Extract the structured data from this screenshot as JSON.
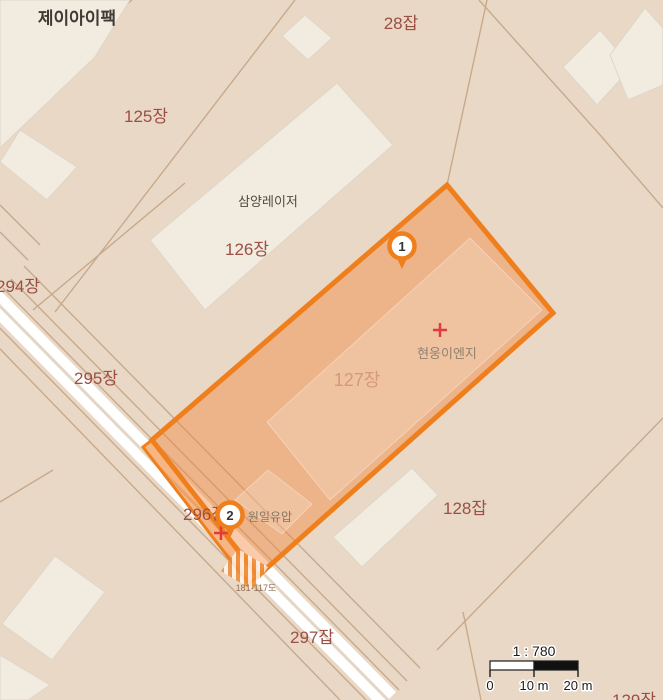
{
  "map": {
    "parcels": {
      "p28": "28잡",
      "p125": "125장",
      "p126": "126장",
      "p127": "127장",
      "p128": "128잡",
      "p129": "129장",
      "p294": "294장",
      "p295": "295장",
      "p296": "296장",
      "p297": "297잡"
    },
    "places": {
      "jay_pack": "제이아이팩",
      "samyang_laser": "삼양레이저",
      "hyunwoong_eng": "현웅이엔지",
      "wonil_hydraulic": "원일유압"
    },
    "road_label": "181-117도",
    "markers": {
      "m1": "1",
      "m2": "2"
    },
    "scalebar": {
      "ratio": "1 : 780",
      "t0": "0",
      "t1": "10 m",
      "t2": "20 m"
    },
    "colors": {
      "background": "#E9D8C5",
      "building_fill": "#F1EBE0",
      "boundary_line": "#C8A98C",
      "road_fill": "#FFFFFF",
      "highlight_border": "#EF7F1C",
      "highlight_fill": "#F8BA8F",
      "strip_fill": "#F2A468",
      "parcel_label": "#9B4F45",
      "centroid_cross": "#E23B3B"
    }
  }
}
